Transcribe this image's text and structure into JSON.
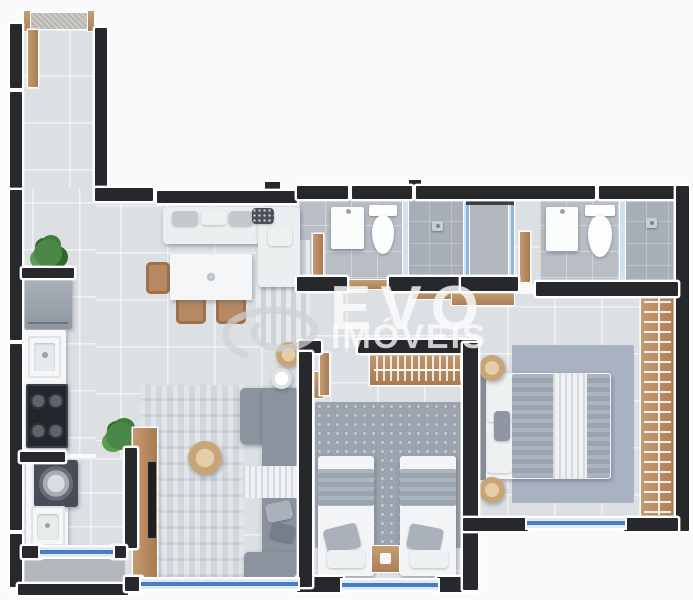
{
  "watermark": {
    "brand_top": "EVO",
    "brand_bottom": "IMÓVEIS",
    "logo": "swirl-logo"
  },
  "palette": {
    "bg": "#fafafa",
    "wall": "#26282c",
    "wallEdge": "#ffffff",
    "floorLight": "#dde0e2",
    "floorBath": "#b9bec6",
    "floorShower": "#a7aeb8",
    "floorShaft": "#b3b8bf",
    "floorBalcony": "#b4b8bd",
    "rugMaster": "#a9b2c2",
    "rugGray": "#9ba3ae",
    "wood": "#b98f66",
    "sofaLight": "#eceff0",
    "sofaGray": "#8b939e",
    "throwWhite": "#eef0f2",
    "duvet": "#9aa3b0",
    "bedWhite": "#f2f4f5",
    "pillowGray": "#aab1ba",
    "fridge": "#9aa2ac",
    "windowBlue": "#3a70c0",
    "glassBlue": "#7fb0dd",
    "glassPale": "#cfe2f2",
    "plant": "#4b8746",
    "plantDark": "#2f6631",
    "rattan": "#c8a477",
    "watermarkColor": "#ffffff"
  },
  "scene": {
    "type": "apartment-floor-plan-render",
    "rooms": [
      "entry-corridor",
      "kitchen",
      "living-dining",
      "hallway",
      "bathroom-social",
      "ventilation-shaft",
      "bathroom-suite",
      "bedroom-double",
      "bedroom-master",
      "laundry",
      "service-balcony"
    ],
    "furniture": [
      "entry-door",
      "refrigerator",
      "kitchen-sink",
      "cooktop",
      "washing-machine",
      "laundry-sink",
      "light-sofa",
      "dining-table",
      "dining-chairs",
      "tv-panel",
      "tv",
      "gray-sectional-sofa",
      "coffee-table",
      "rugs",
      "bathroom-sink",
      "toilet",
      "shower",
      "wardrobe",
      "single-beds",
      "nightstand",
      "double-bed",
      "open-closet",
      "plants",
      "windows"
    ]
  }
}
